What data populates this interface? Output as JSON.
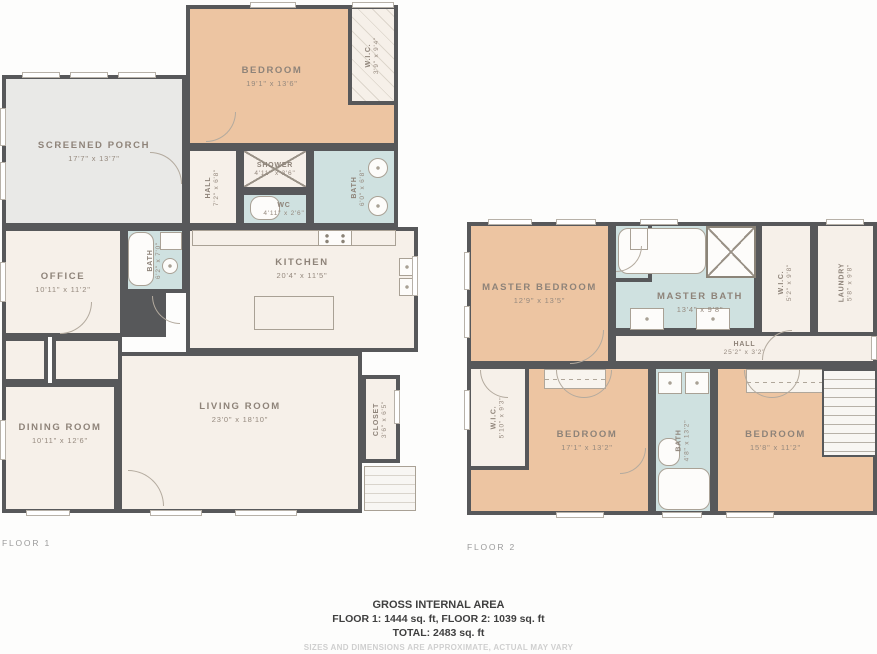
{
  "colors": {
    "wall": "#57585a",
    "bedroom_fill": "#edc5a2",
    "wet_room_fill": "#cfe1e0",
    "room_fill": "#f6f0e9",
    "porch_fill": "#e9e9e7"
  },
  "floors": [
    {
      "label": "FLOOR 1",
      "rooms": [
        {
          "name": "BEDROOM",
          "dims": "19'1\" x 13'6\""
        },
        {
          "name": "W.I.C.",
          "dims": "3'9\" x 9'4\""
        },
        {
          "name": "SCREENED PORCH",
          "dims": "17'7\" x 13'7\""
        },
        {
          "name": "HALL",
          "dims": "7'2\" x 6'8\""
        },
        {
          "name": "SHOWER",
          "dims": "4'11\" x 3'6\""
        },
        {
          "name": "WC",
          "dims": "4'11\" x 2'6\""
        },
        {
          "name": "BATH",
          "dims": "6'0\" x 6'8\""
        },
        {
          "name": "OFFICE",
          "dims": "10'11\" x 11'2\""
        },
        {
          "name": "BATH",
          "dims": "6'2\" x 7'0\""
        },
        {
          "name": "KITCHEN",
          "dims": "20'4\" x 11'5\""
        },
        {
          "name": "DINING ROOM",
          "dims": "10'11\" x 12'6\""
        },
        {
          "name": "LIVING ROOM",
          "dims": "23'0\" x 18'10\""
        },
        {
          "name": "CLOSET",
          "dims": "3'6\" x 6'5\""
        }
      ]
    },
    {
      "label": "FLOOR 2",
      "rooms": [
        {
          "name": "MASTER BEDROOM",
          "dims": "12'9\" x 13'5\""
        },
        {
          "name": "WC",
          "dims": "3'6\" x 4'4\""
        },
        {
          "name": "MASTER BATH",
          "dims": "13'4\" x 9'8\""
        },
        {
          "name": "W.I.C.",
          "dims": "5'2\" x 9'8\""
        },
        {
          "name": "LAUNDRY",
          "dims": "5'8\" x 9'8\""
        },
        {
          "name": "HALL",
          "dims": "25'2\" x 3'2\""
        },
        {
          "name": "W.I.C.",
          "dims": "5'10\" x 9'3\""
        },
        {
          "name": "BEDROOM",
          "dims": "17'1\" x 13'2\""
        },
        {
          "name": "BATH",
          "dims": "4'8\" x 13'2\""
        },
        {
          "name": "BEDROOM",
          "dims": "15'8\" x 11'2\""
        }
      ]
    }
  ],
  "footer": {
    "title": "GROSS INTERNAL AREA",
    "areas_line": "FLOOR 1: 1444 sq. ft, FLOOR 2: 1039 sq. ft",
    "total_line": "TOTAL: 2483 sq. ft",
    "disclaimer": "SIZES AND DIMENSIONS ARE APPROXIMATE, ACTUAL MAY VARY"
  }
}
